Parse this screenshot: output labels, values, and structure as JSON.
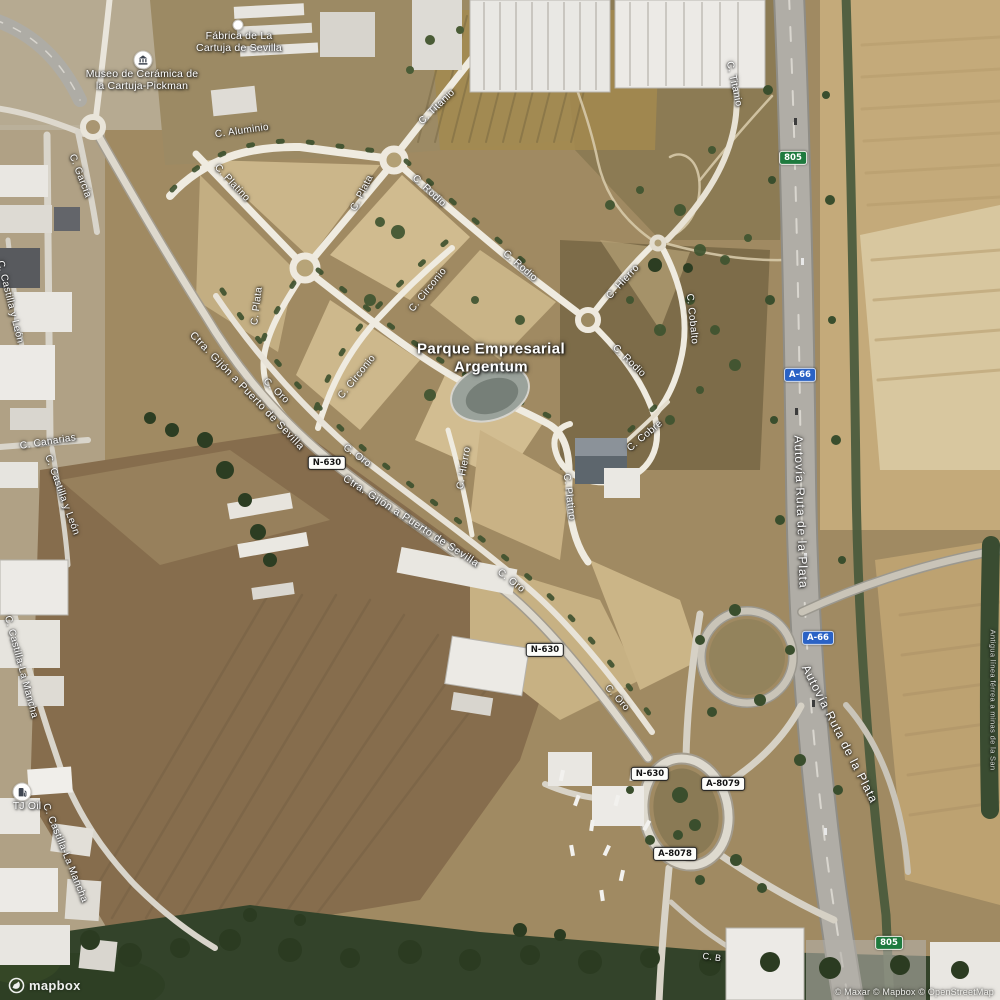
{
  "map": {
    "area_label": {
      "line1": "Parque Empresarial",
      "line2": "Argentum"
    },
    "street_labels": [
      {
        "text": "C. Aluminio",
        "x": 242,
        "y": 131,
        "rot": -8
      },
      {
        "text": "C. Titanio",
        "x": 437,
        "y": 107,
        "rot": -44
      },
      {
        "text": "C. Titanio",
        "x": 734,
        "y": 84,
        "rot": 78
      },
      {
        "text": "C. Platino",
        "x": 232,
        "y": 183,
        "rot": 47
      },
      {
        "text": "C. Plata",
        "x": 362,
        "y": 193,
        "rot": -63
      },
      {
        "text": "C. Plata",
        "x": 257,
        "y": 306,
        "rot": -83
      },
      {
        "text": "C. Rodio",
        "x": 429,
        "y": 191,
        "rot": 43
      },
      {
        "text": "C. Rodio",
        "x": 520,
        "y": 266,
        "rot": 41
      },
      {
        "text": "C. Rodio",
        "x": 629,
        "y": 361,
        "rot": 44
      },
      {
        "text": "C. Circonio",
        "x": 428,
        "y": 290,
        "rot": -51
      },
      {
        "text": "C. Circonio",
        "x": 357,
        "y": 377,
        "rot": -51
      },
      {
        "text": "C. Platino",
        "x": 569,
        "y": 497,
        "rot": 83
      },
      {
        "text": "C. Hierro",
        "x": 623,
        "y": 282,
        "rot": -47
      },
      {
        "text": "C. Hierro",
        "x": 464,
        "y": 468,
        "rot": -80
      },
      {
        "text": "C. Cobre",
        "x": 645,
        "y": 436,
        "rot": -40
      },
      {
        "text": "C. Cobalto",
        "x": 692,
        "y": 319,
        "rot": 84
      },
      {
        "text": "C. Oro",
        "x": 276,
        "y": 391,
        "rot": 44
      },
      {
        "text": "C. Oro",
        "x": 357,
        "y": 456,
        "rot": 36
      },
      {
        "text": "C. Oro",
        "x": 511,
        "y": 581,
        "rot": 38
      },
      {
        "text": "C. Oro",
        "x": 617,
        "y": 698,
        "rot": 48
      },
      {
        "text": "Ctra. Gijón a Puerto de Sevilla",
        "x": 247,
        "y": 391,
        "rot": 46,
        "size": 10.5,
        "spacing": 0.6
      },
      {
        "text": "Ctra. Gijón a Puerto de Sevilla",
        "x": 411,
        "y": 521,
        "rot": 33,
        "size": 10.5,
        "spacing": 0.6
      },
      {
        "text": "C. García",
        "x": 80,
        "y": 176,
        "rot": 69
      },
      {
        "text": "C. Castilla y León",
        "x": 10,
        "y": 302,
        "rot": 76
      },
      {
        "text": "C. Canarias",
        "x": 48,
        "y": 442,
        "rot": -9
      },
      {
        "text": "C. Castilla y León",
        "x": 62,
        "y": 495,
        "rot": 70
      },
      {
        "text": "C. Castilla-La Mancha",
        "x": 21,
        "y": 667,
        "rot": 75
      },
      {
        "text": "C. Castilla-La Mancha",
        "x": 65,
        "y": 853,
        "rot": 68
      },
      {
        "text": "Autovía Ruta de la Plata",
        "x": 801,
        "y": 512,
        "rot": 88,
        "size": 12,
        "spacing": 1
      },
      {
        "text": "Autovía Ruta de la Plata",
        "x": 840,
        "y": 734,
        "rot": 63,
        "size": 12,
        "spacing": 1
      },
      {
        "text": "C. B",
        "x": 712,
        "y": 957,
        "rot": 8,
        "size": 9
      },
      {
        "text": "Antigua línea férrea a minas de la San",
        "x": 993,
        "y": 700,
        "rot": 90,
        "size": 7.5,
        "opacity": 0.8
      }
    ],
    "shields": [
      {
        "text": "N-630",
        "style": "national",
        "x": 327,
        "y": 463
      },
      {
        "text": "N-630",
        "style": "national",
        "x": 545,
        "y": 650
      },
      {
        "text": "N-630",
        "style": "national",
        "x": 650,
        "y": 774
      },
      {
        "text": "A-8079",
        "style": "national",
        "x": 723,
        "y": 784
      },
      {
        "text": "A-8078",
        "style": "national",
        "x": 675,
        "y": 854
      },
      {
        "text": "A-66",
        "style": "autovia",
        "x": 800,
        "y": 375
      },
      {
        "text": "A-66",
        "style": "autovia",
        "x": 818,
        "y": 638
      },
      {
        "text": "805",
        "style": "green",
        "x": 793,
        "y": 158
      },
      {
        "text": "805",
        "style": "green",
        "x": 889,
        "y": 943
      }
    ],
    "pois": [
      {
        "icon": "museum-icon",
        "x": 143,
        "y": 60,
        "lines": [
          "Museo de Cerámica de",
          "la Cartuja-Pickman"
        ],
        "label_x": 142,
        "label_y": 68
      },
      {
        "icon": "poi-dot",
        "x": 238,
        "y": 25,
        "lines": [
          "Fábrica de La",
          "Cartuja de Sevilla"
        ],
        "label_x": 239,
        "label_y": 30
      },
      {
        "icon": "fuel-icon",
        "x": 22,
        "y": 792,
        "lines": [
          "TJ Oil"
        ],
        "label_x": 27,
        "label_y": 800
      }
    ],
    "attribution": {
      "logo_text": "mapbox",
      "credits": "© Maxar © Mapbox © OpenStreetMap"
    },
    "colors": {
      "label": "#ffffff",
      "halo": "#2b2b2b",
      "autovia_shield": "#2a62c5",
      "national_shield": "#ffffff",
      "green_shield": "#1e7a3e",
      "street": "#efebe0",
      "highway": "#b0ada6",
      "terrain": "#a08a62"
    }
  }
}
